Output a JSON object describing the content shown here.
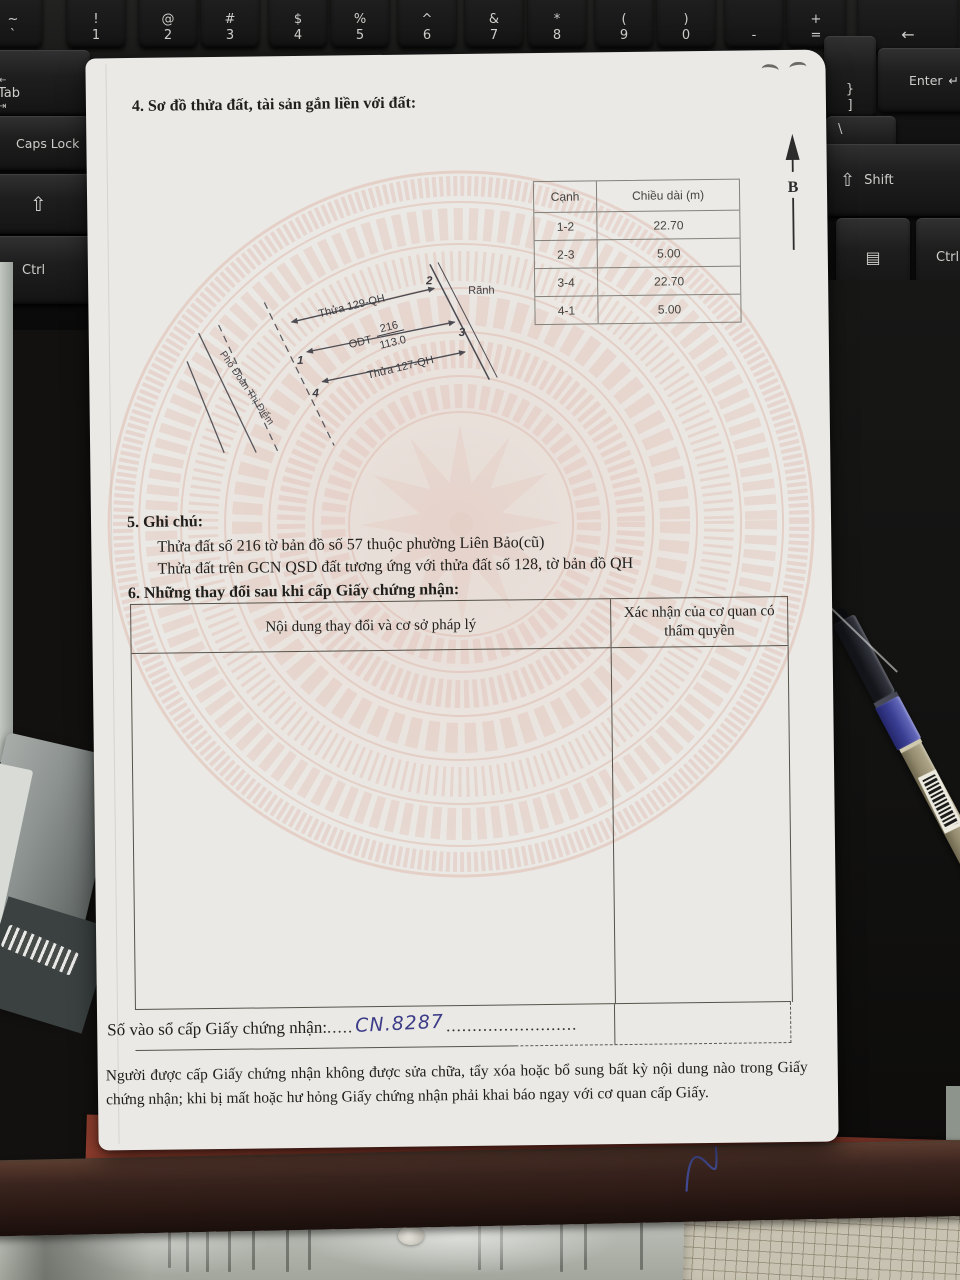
{
  "colors": {
    "paper": "#ebe9e5",
    "watermark_pink": "#dfbcb0",
    "handwriting_ink": "#3c3c88",
    "folder_red": "#8e3a2b",
    "desk_wood": "#3a241e"
  },
  "keyboard": {
    "backtick": {
      "top": "~",
      "bot": "`"
    },
    "num_keys": [
      {
        "top": "!",
        "bot": "1"
      },
      {
        "top": "@",
        "bot": "2"
      },
      {
        "top": "#",
        "bot": "3"
      },
      {
        "top": "$",
        "bot": "4"
      },
      {
        "top": "%",
        "bot": "5"
      },
      {
        "top": "^",
        "bot": "6"
      },
      {
        "top": "&",
        "bot": "7"
      },
      {
        "top": "*",
        "bot": "8"
      },
      {
        "top": "(",
        "bot": "9"
      },
      {
        "top": ")",
        "bot": "0"
      },
      {
        "top": "-",
        "bot": ""
      },
      {
        "top": "+",
        "bot": "="
      }
    ],
    "backspace": "←",
    "tab": "Tab",
    "tab_in": "⇤",
    "tab_out": "⇥",
    "bracket_top": "}",
    "bracket_bot": "]",
    "enter": "Enter",
    "enter_icon": "↵",
    "caps": "Caps Lock",
    "backslash": "\\",
    "shift_icon": "⇧",
    "shift_label": "Shift",
    "ctrl_left": "Ctrl",
    "ctrl_right": "Ctrl",
    "menu_icon": "▤"
  },
  "document": {
    "section4_title": "4. Sơ đồ thửa đất, tài sản gắn liền với đất:",
    "north_label": "B",
    "edge_table": {
      "headers": [
        "Cạnh",
        "Chiều dài (m)"
      ],
      "rows": [
        [
          "1-2",
          "22.70"
        ],
        [
          "2-3",
          "5.00"
        ],
        [
          "3-4",
          "22.70"
        ],
        [
          "4-1",
          "5.00"
        ]
      ]
    },
    "diagram": {
      "parcel_upper": "Thửa 129-QH",
      "land_use": "ODT",
      "parcel_number": "216",
      "area": "113.0",
      "parcel_lower": "Thửa 127-QH",
      "ditch": "Rãnh",
      "street": "Phố Đoàn Thị Điểm",
      "v1": "1",
      "v2": "2",
      "v3": "3",
      "v4": "4"
    },
    "section5_title": "5. Ghi chú:",
    "note_line1": "Thửa đất số 216 tờ bản đồ số 57 thuộc phường Liên Bảo(cũ)",
    "note_line2": "Thửa đất trên GCN QSD đất tương ứng với thửa đất số 128, tờ bản đồ QH",
    "section6_title": "6. Những thay đổi sau khi cấp Giấy chứng nhận:",
    "changes_table": {
      "col1": "Nội dung thay đổi và cơ sở pháp lý",
      "col2": "Xác nhận của cơ quan có thẩm quyền"
    },
    "serial": {
      "label": "Số vào sổ cấp Giấy chứng nhận:",
      "dots_before": ".....",
      "value": "CN.8287",
      "dots_after": "........................."
    },
    "footer_note": "Người được cấp Giấy chứng nhận không được sửa chữa, tẩy xóa hoặc bổ sung bất kỳ nội dung nào trong Giấy chứng nhận; khi bị mất hoặc hư hỏng Giấy chứng nhận phải khai báo ngay với cơ quan cấp Giấy."
  }
}
